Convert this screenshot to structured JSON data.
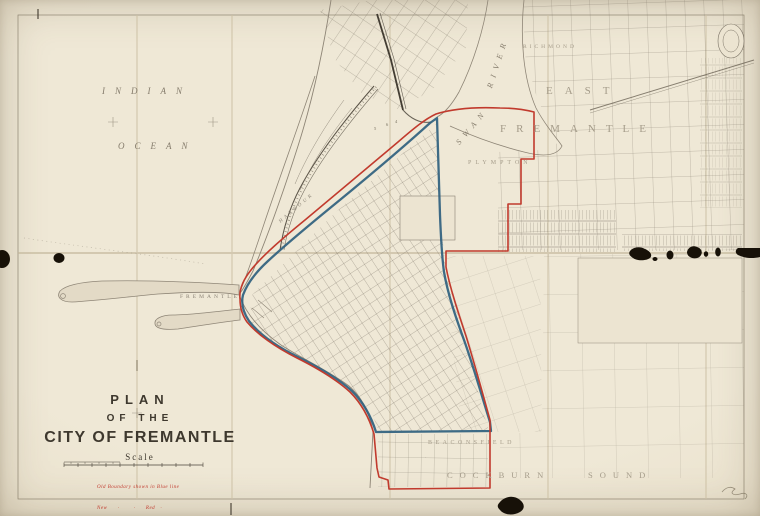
{
  "colors": {
    "paper": "#ece4d1",
    "ink": "#7b7365",
    "red": "#c13a2d",
    "blue": "#2f5f7e",
    "label": "#978e7d",
    "title": "#3e382e",
    "damage": "#171108"
  },
  "title_block": {
    "line1": "PLAN",
    "line2": "OF  THE",
    "line3": "CITY OF FREMANTLE",
    "scale_label": "Scale",
    "legend_line1": "Old Boundary shown in Blue line",
    "legend_line2": "New      ·        ·      Red   ·"
  },
  "water_labels": {
    "ocean_word1": "INDIAN",
    "ocean_word2": "OCEAN",
    "river_word1": "SWAN",
    "river_word2": "RIVER",
    "harbour": "HARBOUR"
  },
  "district_labels": {
    "port": "FREMANTLE",
    "richmond": "RICHMOND",
    "east": "EAST",
    "east_fremantle": "FREMANTLE",
    "plympton": "PLYMPTON",
    "beaconsfield": "BEACONSFIELD",
    "cockburn": "COCKBURN",
    "sound": "SOUND"
  },
  "soundings": [
    "5",
    "6",
    "4"
  ]
}
